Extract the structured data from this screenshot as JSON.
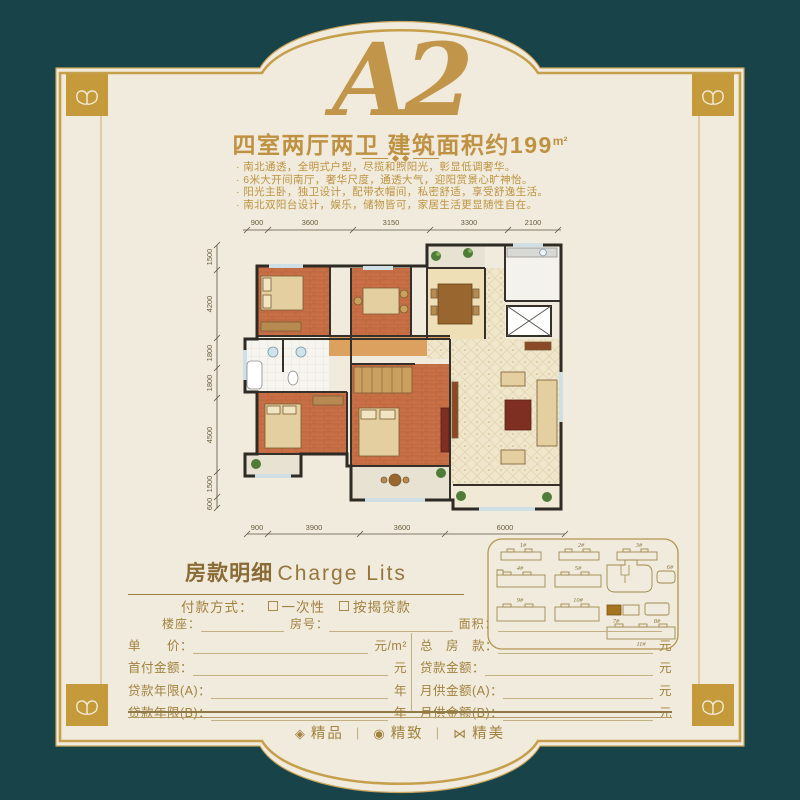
{
  "header": {
    "plan_code": "A2",
    "summary": "四室两厅两卫 建筑面积约199",
    "summary_unit": "m²",
    "bullets": [
      "· 南北通透，全明式户型，尽揽和煦阳光，彰显低调奢华。",
      "· 6米大开间南厅，奢华尺度，通透大气，迎阳赏景心旷神怡。",
      "· 阳光主卧，独卫设计，配带衣帽间，私密舒适，享受舒逸生活。",
      "· 南北双阳台设计，娱乐，储物皆可，家居生活更显随性自在。"
    ]
  },
  "floorplan": {
    "dims_top": [
      "900",
      "3600",
      "3150",
      "3300",
      "2100"
    ],
    "dims_left": [
      "1500",
      "4200",
      "1800",
      "1800",
      "4500",
      "1500",
      "600"
    ],
    "dims_bottom": [
      "900",
      "3900",
      "3600",
      "6000"
    ]
  },
  "siteplan": {
    "buildings": [
      "1#",
      "2#",
      "3#",
      "4#",
      "5#",
      "6#",
      "7#",
      "8#",
      "9#",
      "10#",
      "11#"
    ]
  },
  "charge": {
    "title_zh": "房款明细",
    "title_en": "Charge Lits",
    "payment_label": "付款方式：",
    "payment_options": [
      "一次性",
      "按揭贷款"
    ],
    "info_fields": [
      "楼座：",
      "房号：",
      "面积："
    ],
    "left_rows": [
      {
        "label": "单　　价：",
        "unit": "元/m²"
      },
      {
        "label": "首付金额：",
        "unit": "元"
      },
      {
        "label": "贷款年限(A)：",
        "unit": "年"
      },
      {
        "label": "贷款年限(B)：",
        "unit": "年"
      }
    ],
    "right_rows": [
      {
        "label": "总　房　款：",
        "unit": "元"
      },
      {
        "label": "贷款金额：",
        "unit": "元"
      },
      {
        "label": "月供金额(A)：",
        "unit": "元"
      },
      {
        "label": "月供金额(B)：",
        "unit": "元"
      }
    ]
  },
  "footer": {
    "items": [
      {
        "glyph": "◈",
        "label": "精品"
      },
      {
        "glyph": "◉",
        "label": "精致"
      },
      {
        "glyph": "⋈",
        "label": "精美"
      }
    ]
  },
  "colors": {
    "background_teal": "#174349",
    "panel_cream": "#f0ebdc",
    "frame_gold": "#c69f4c",
    "text_gold": "#bd9340",
    "floor_orange": "#c86f45"
  }
}
